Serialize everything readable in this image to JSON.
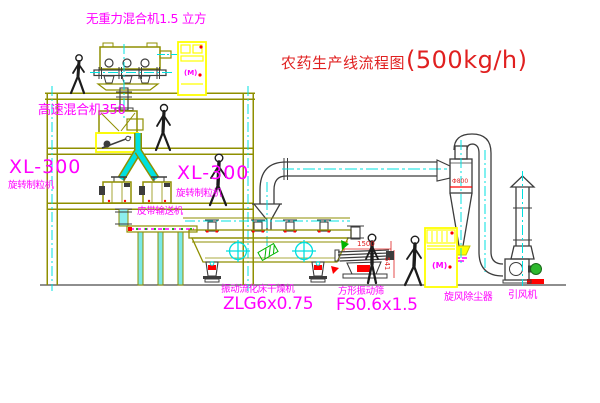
{
  "title": {
    "text": "农药生产线流程图",
    "capacity": "(500kg/h)"
  },
  "labels": {
    "top_mixer": "无重力混合机1.5 立方",
    "high_speed_mixer": "高速混合机350",
    "granulator_left_model": "XL-300",
    "granulator_left_name": "旋转制粒机",
    "granulator_right_model": "XL-300",
    "granulator_right_name": "旋转制粒机",
    "belt_conveyor": "皮带输送机",
    "dryer_name": "振动流化床干燥机",
    "dryer_model": "ZLG6x0.75",
    "sieve_name": "方形振动筛",
    "sieve_model": "FS0.6x1.5",
    "cyclone_name": "旋风除尘器",
    "fan_name": "引风机"
  },
  "dimensions": {
    "sieve_length": "1500",
    "sieve_height": "541",
    "cyclone_note": "Φ800"
  },
  "panel_marking": "(M)",
  "colors": {
    "line_olive": "#8f8f00",
    "line_dark": "#3c3c3c",
    "centerline_cyan": "#00e0e0",
    "cabinet_yellow": "#ffff00",
    "label_magenta": "#ff00ff",
    "title_red": "#e02020",
    "accent_green": "#00b400",
    "accent_red": "#ff0000"
  }
}
